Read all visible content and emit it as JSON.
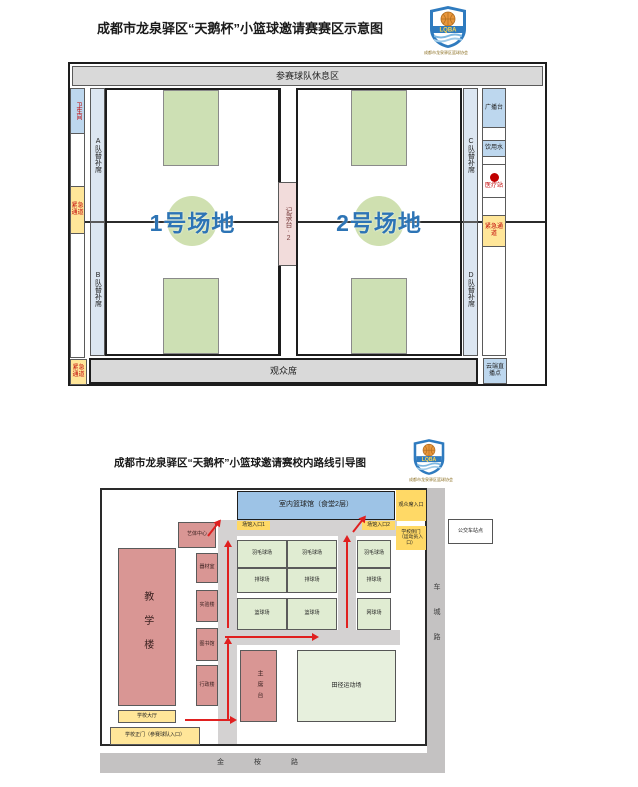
{
  "accent": {
    "court_label_blue": "#2d74b5",
    "emergency_red": "#c00000",
    "arrow_red": "#e02020"
  },
  "logo": {
    "abbr": "LQBA",
    "caption": "成都市龙泉驿区篮球协会"
  },
  "top": {
    "title": "成都市龙泉驿区“天鹅杯”小篮球邀请赛赛区示意图",
    "rest_area": "参赛球队休息区",
    "audience": "观众席",
    "toilet": "卫生间",
    "emergency": "紧急通道",
    "bench_a": "A队替补席",
    "bench_b": "B队替补席",
    "bench_c": "C队替补席",
    "bench_d": "D队替补席",
    "court1": "1号场地",
    "court2": "2号场地",
    "recorder": "记录台·2",
    "broadcast": "广播台",
    "water": "饮用水",
    "medical": "医疗站",
    "live": "云端直播点"
  },
  "bottom": {
    "title": "成都市龙泉驿区“天鹅杯”小篮球邀请赛校内路线引导图",
    "gym": "室内篮球馆（食堂2层）",
    "entrance1": "场馆入口1",
    "entrance2": "场馆入口2",
    "audience_entrance": "观众席入口",
    "side_gate": "学校侧门（运动员入口）",
    "bus_stop": "公交车站点",
    "teaching": "教学楼",
    "art_center": "艺体中心",
    "equipment": "器材室",
    "lab": "实验楼",
    "library": "图书馆",
    "admin": "行政楼",
    "hall": "学校大厅",
    "main_gate": "学校正门（参赛球队入口）",
    "stage": "主席台",
    "field": "田径运动场",
    "courts": [
      [
        "羽毛球场",
        "羽毛球场"
      ],
      [
        "排球场",
        "排球场"
      ],
      [
        "篮球场",
        "篮球场"
      ]
    ],
    "courts_right": [
      "羽毛球场",
      "排球场",
      "网球场"
    ],
    "road_east": "车城路",
    "road_south": "金桉路"
  }
}
